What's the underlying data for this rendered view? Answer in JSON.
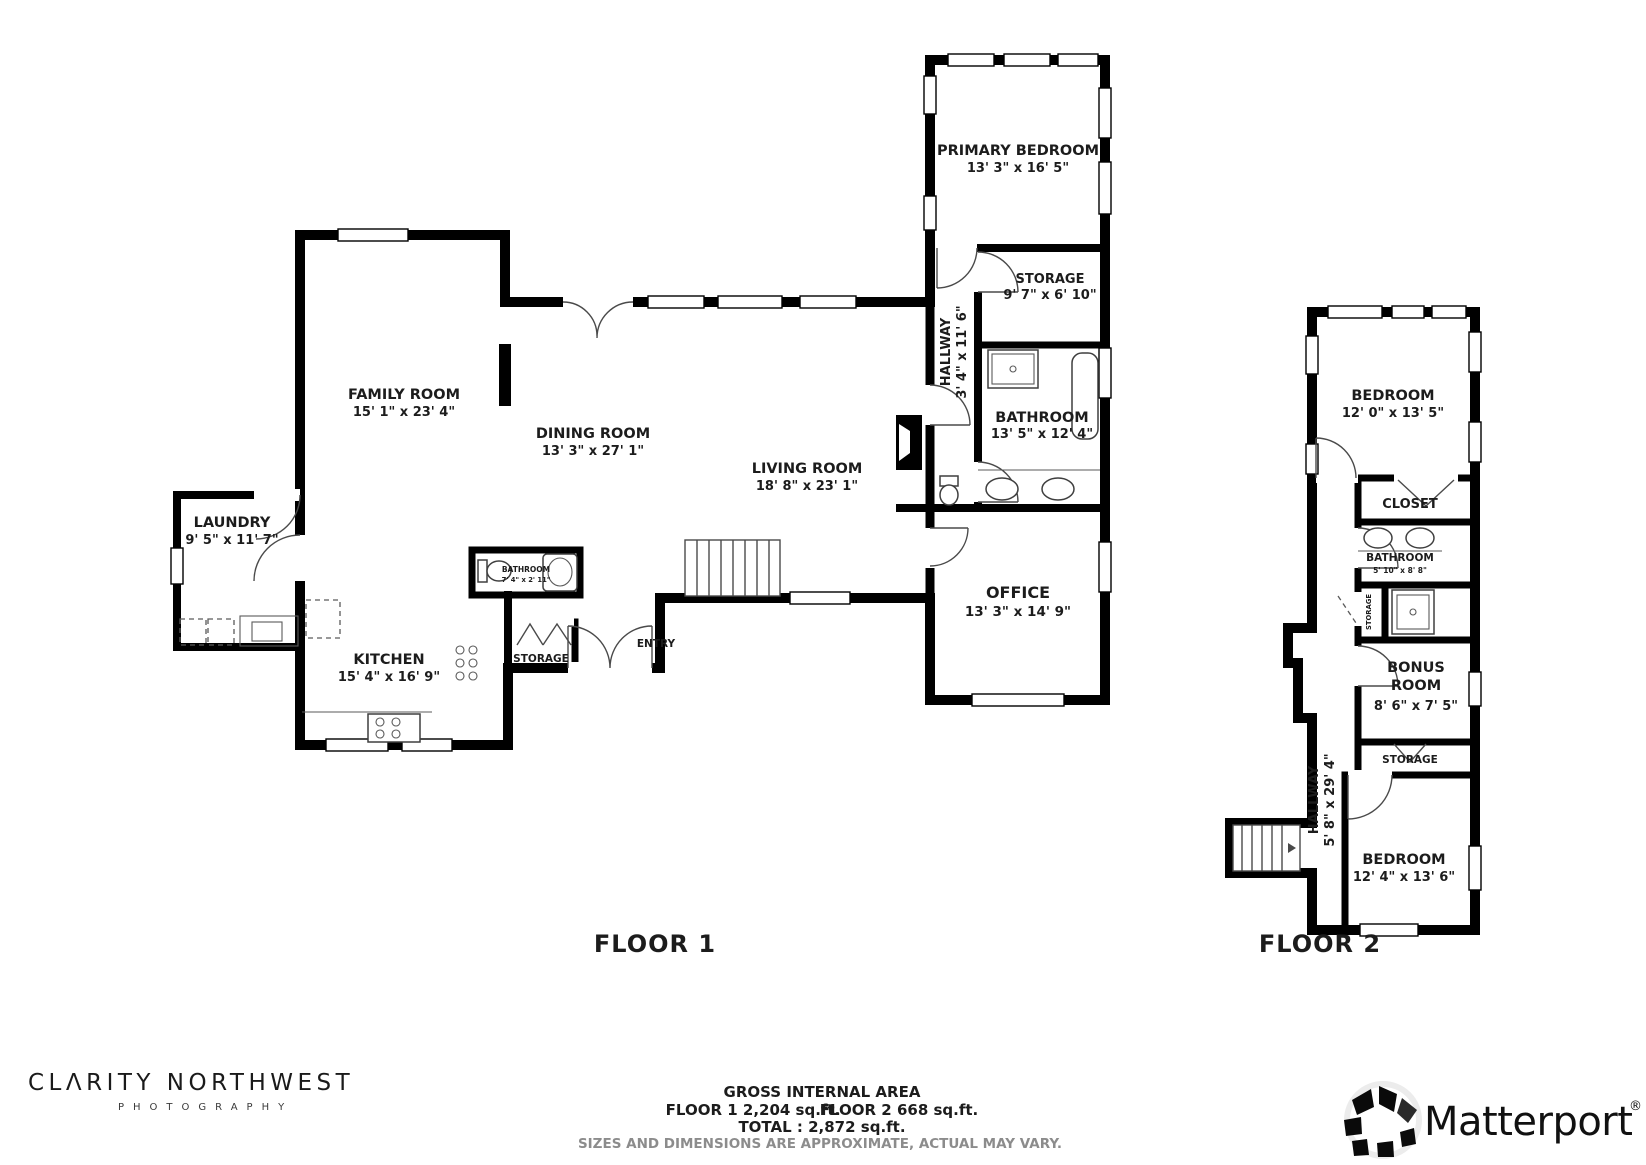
{
  "colors": {
    "wall": "#000000",
    "text": "#1c1c1c",
    "muted": "#8c8c8c"
  },
  "floor1": {
    "caption": "FLOOR 1",
    "rooms": {
      "family": {
        "name": "FAMILY ROOM",
        "dims": "15' 1\" x 23' 4\""
      },
      "dining": {
        "name": "DINING ROOM",
        "dims": "13' 3\" x 27' 1\""
      },
      "living": {
        "name": "LIVING ROOM",
        "dims": "18' 8\" x 23' 1\""
      },
      "kitchen": {
        "name": "KITCHEN",
        "dims": "15' 4\" x 16' 9\""
      },
      "laundry": {
        "name": "LAUNDRY",
        "dims": "9' 5\" x 11' 7\""
      },
      "primary_bedroom": {
        "name": "PRIMARY BEDROOM",
        "dims": "13' 3\" x 16' 5\""
      },
      "storage_wing": {
        "name": "STORAGE",
        "dims": "9' 7\" x 6' 10\""
      },
      "hallway": {
        "name": "HALLWAY",
        "dims": "3' 4\" x 11' 6\""
      },
      "bathroom": {
        "name": "BATHROOM",
        "dims": "13' 5\" x 12' 4\""
      },
      "office": {
        "name": "OFFICE",
        "dims": "13' 3\" x 14' 9\""
      },
      "bathroom_small": {
        "name": "BATHROOM",
        "dims": "7' 4\" x 2' 11\""
      },
      "storage_kitchen": {
        "name": "STORAGE"
      },
      "entry": {
        "name": "ENTRY"
      }
    }
  },
  "floor2": {
    "caption": "FLOOR 2",
    "rooms": {
      "bedroom_top": {
        "name": "BEDROOM",
        "dims": "12' 0\" x 13' 5\""
      },
      "closet": {
        "name": "CLOSET"
      },
      "bathroom": {
        "name": "BATHROOM",
        "dims": "5' 10\" x 8' 8\""
      },
      "storage_small": {
        "name": "STORAGE"
      },
      "bonus": {
        "name_line1": "BONUS",
        "name_line2": "ROOM",
        "dims": "8' 6\" x 7' 5\""
      },
      "storage": {
        "name": "STORAGE"
      },
      "hallway": {
        "name": "HALLWAY",
        "dims": "5' 8\" x 29' 4\""
      },
      "bedroom_bottom": {
        "name": "BEDROOM",
        "dims": "12' 4\" x 13' 6\""
      }
    }
  },
  "footer": {
    "title": "GROSS INTERNAL AREA",
    "floor1_area": "FLOOR 1 2,204 sq.ft.",
    "floor2_area": "FLOOR 2 668 sq.ft.",
    "total": "TOTAL : 2,872 sq.ft.",
    "disclaimer": "SIZES AND DIMENSIONS ARE APPROXIMATE, ACTUAL MAY VARY."
  },
  "branding": {
    "photographer_line1": "CLΛRITY NORTHWEST",
    "photographer_line2": "PHOTOGRAPHY",
    "matterport_wordmark": "Matterport",
    "registered_mark": "®"
  }
}
